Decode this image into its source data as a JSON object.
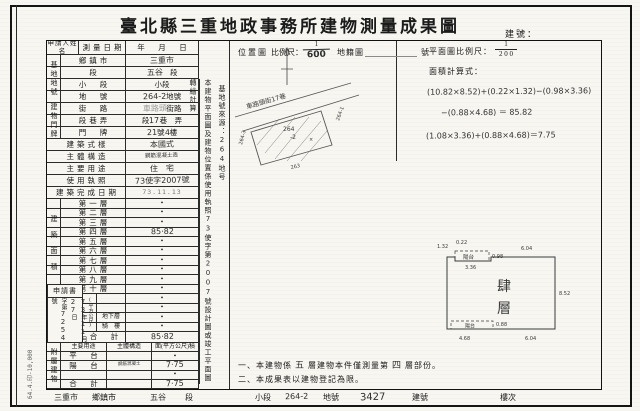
{
  "page": {
    "title": "臺北縣三重地政事務所建物測量成果圖",
    "building_no_label": "建號：",
    "print_note": "64.4.印-10,000"
  },
  "header": {
    "location_map": "位置圖",
    "scale_label": "比例尺：",
    "scale_num": "1",
    "scale_den": "600",
    "cadastral": "地籍圖",
    "sheet_no": "號",
    "plan_scale_label": "平面圖比例尺：",
    "plan_scale_num": "1",
    "plan_scale_den": "2 0 0",
    "calc_label": "面積計算式：",
    "calc_line1": "(10.82×8.52)+(0.22×1.32)−(0.98×3.36)",
    "calc_line2": "−(0.88×4.68) ＝ 85.82",
    "calc_line3": "(1.08×3.36)+(0.88×4.68)＝7.75"
  },
  "table": {
    "applicant_label": "申請人姓名",
    "survey_date_label": "測量日期",
    "ymd": "年　月　日",
    "groups": {
      "site": "基地地號",
      "door": "建物門牌",
      "area": "建築面積",
      "unit": "(平方公尺)",
      "attached": "附屬建物"
    },
    "info_rows": [
      {
        "label": "鄉鎮市",
        "segs": [
          {
            "t": "三重市",
            "c": "hand"
          }
        ]
      },
      {
        "label": "段",
        "segs": [
          {
            "t": "五谷",
            "c": "hand"
          },
          {
            "t": "　段",
            "c": "p"
          }
        ]
      },
      {
        "label": "小　段",
        "segs": [
          {
            "t": "小段",
            "c": "p"
          }
        ]
      },
      {
        "label": "地　號",
        "segs": [
          {
            "t": "264-2",
            "c": "hand"
          },
          {
            "t": " 地號",
            "c": "p"
          }
        ]
      },
      {
        "label": "街　路",
        "segs": [
          {
            "t": "車路頭",
            "c": "hand faint"
          },
          {
            "t": " 街路",
            "c": "p"
          }
        ]
      },
      {
        "label": "段巷弄",
        "segs": [
          {
            "t": "段",
            "c": "p"
          },
          {
            "t": "17",
            "c": "hand"
          },
          {
            "t": "巷",
            "c": "p"
          },
          {
            "t": "　弄",
            "c": "p"
          }
        ]
      },
      {
        "label": "門　牌",
        "segs": [
          {
            "t": "21",
            "c": "hand"
          },
          {
            "t": "號 ",
            "c": "p"
          },
          {
            "t": "4",
            "c": "hand"
          },
          {
            "t": "樓",
            "c": "p"
          }
        ]
      },
      {
        "label": "建築式樣",
        "wide": true,
        "segs": [
          {
            "t": "本國式",
            "c": "hand"
          }
        ]
      },
      {
        "label": "主體構造",
        "wide": true,
        "segs": [
          {
            "t": "鋼筋混凝土造",
            "c": "hand tiny"
          }
        ]
      },
      {
        "label": "主要用途",
        "wide": true,
        "segs": [
          {
            "t": "住　宅",
            "c": "hand"
          }
        ]
      },
      {
        "label": "使用執照",
        "wide": true,
        "segs": [
          {
            "t": "73使字2007號",
            "c": "hand"
          }
        ]
      },
      {
        "label": "建築完成日期",
        "wide": true,
        "segs": [
          {
            "t": "73.11.13",
            "c": "stamp"
          }
        ]
      }
    ],
    "floors": [
      {
        "label": "第一層",
        "segs": [
          {
            "t": "•",
            "c": "p dot"
          }
        ]
      },
      {
        "label": "第二層",
        "segs": [
          {
            "t": "•",
            "c": "p dot"
          }
        ]
      },
      {
        "label": "第三層",
        "segs": [
          {
            "t": "•",
            "c": "p dot"
          }
        ]
      },
      {
        "label": "第四層",
        "segs": [
          {
            "t": "85·82",
            "c": "hand"
          }
        ]
      },
      {
        "label": "第五層",
        "segs": [
          {
            "t": "•",
            "c": "p dot"
          }
        ]
      },
      {
        "label": "第六層",
        "segs": [
          {
            "t": "•",
            "c": "p dot"
          }
        ]
      },
      {
        "label": "第七層",
        "segs": [
          {
            "t": "•",
            "c": "p dot"
          }
        ]
      },
      {
        "label": "第八層",
        "segs": [
          {
            "t": "•",
            "c": "p dot"
          }
        ]
      },
      {
        "label": "第九層",
        "segs": [
          {
            "t": "•",
            "c": "p dot"
          }
        ]
      },
      {
        "label": "第十層",
        "segs": [
          {
            "t": "•",
            "c": "p dot"
          }
        ]
      }
    ],
    "lower_rows": [
      {
        "label": "",
        "segs": [
          {
            "t": "•",
            "c": "p dot"
          }
        ]
      },
      {
        "label": "",
        "segs": [
          {
            "t": "•",
            "c": "p dot"
          }
        ]
      },
      {
        "label": "地下層",
        "segs": [
          {
            "t": "•",
            "c": "p dot"
          }
        ]
      },
      {
        "label": "騎　樓",
        "segs": [
          {
            "t": "•",
            "c": "p dot"
          }
        ]
      }
    ],
    "total_row": {
      "label": "合　計",
      "segs": [
        {
          "t": "85·82",
          "c": "hand"
        }
      ]
    },
    "attached": {
      "header": [
        "主要用途",
        "主體構造",
        "面(平方公尺)積"
      ],
      "rows": [
        {
          "a": "平　台",
          "b": [],
          "c": [
            {
              "t": "•",
              "c": "p dot"
            }
          ]
        },
        {
          "a": "陽　台",
          "b": [
            {
              "t": "鋼筋混凝土",
              "c": "hand tiny2"
            }
          ],
          "c": [
            {
              "t": "7·75",
              "c": "hand"
            }
          ]
        },
        {
          "a": "",
          "b": [],
          "c": [
            {
              "t": "•",
              "c": "p dot"
            }
          ]
        },
        {
          "a": "合　計",
          "b": [],
          "c": [
            {
              "t": "7·75",
              "c": "hand"
            }
          ]
        }
      ]
    },
    "application": {
      "title": "申請書",
      "col_left": [
        {
          "t": "字第",
          "c": "p"
        },
        {
          "t": "7254",
          "c": "hand"
        },
        {
          "t": "號",
          "c": "p"
        }
      ],
      "col_right": [
        {
          "t": "73",
          "c": "hand"
        },
        {
          "t": "年",
          "c": "p"
        },
        {
          "t": "11",
          "c": "hand"
        },
        {
          "t": "月",
          "c": "p"
        },
        {
          "t": "27",
          "c": "hand"
        },
        {
          "t": "日",
          "c": "p"
        }
      ]
    }
  },
  "vnotes": {
    "basis": [
      {
        "t": "本建物平面圖及建物位置係使用執照",
        "c": "p"
      },
      {
        "t": "73",
        "c": "hand"
      },
      {
        "t": "使字第",
        "c": "p"
      },
      {
        "t": "2007",
        "c": "hand"
      },
      {
        "t": "號設計圖或竣工平面圖轉繪計算",
        "c": "p"
      }
    ],
    "source": [
      {
        "t": "基地號來源：",
        "c": "p"
      },
      {
        "t": "264地号",
        "c": "hand"
      }
    ]
  },
  "location_map": {
    "street": "車路頭街17巷",
    "parcel_center_1": "264",
    "parcel_center_2": "-2",
    "parcel_left": "264-3",
    "parcel_right": "264-1",
    "parcel_bottom": "263"
  },
  "plan": {
    "floor_char_1": "肆",
    "floor_char_2": "層",
    "balcony_top": "陽台",
    "balcony_bottom": "陽台",
    "dims": {
      "top1": "1.32",
      "top2": "0.22",
      "balcony_w": "3.36",
      "balcony_d": "0.98",
      "top_right": "6.04",
      "right": "8.52",
      "bottom_left": "4.68",
      "notch_d": "0.88",
      "bottom_right": "6.04"
    }
  },
  "notes": {
    "n1_pre": "一、本建物係",
    "n1_hand1": "五",
    "n1_mid": "層建物本件僅測量第",
    "n1_hand2": "四",
    "n1_suf": "層部份。",
    "n2": "二、本成果表以建物登記為限。"
  },
  "footer": {
    "f1_hand": "三重市",
    "f1": "鄉鎮市",
    "f2_hand": "五谷",
    "f2": "段",
    "f3": "小段",
    "f4_hand": "264-2",
    "f4": "地號",
    "f5_hand": "3427",
    "f5": "建號",
    "f6": "樓次"
  }
}
